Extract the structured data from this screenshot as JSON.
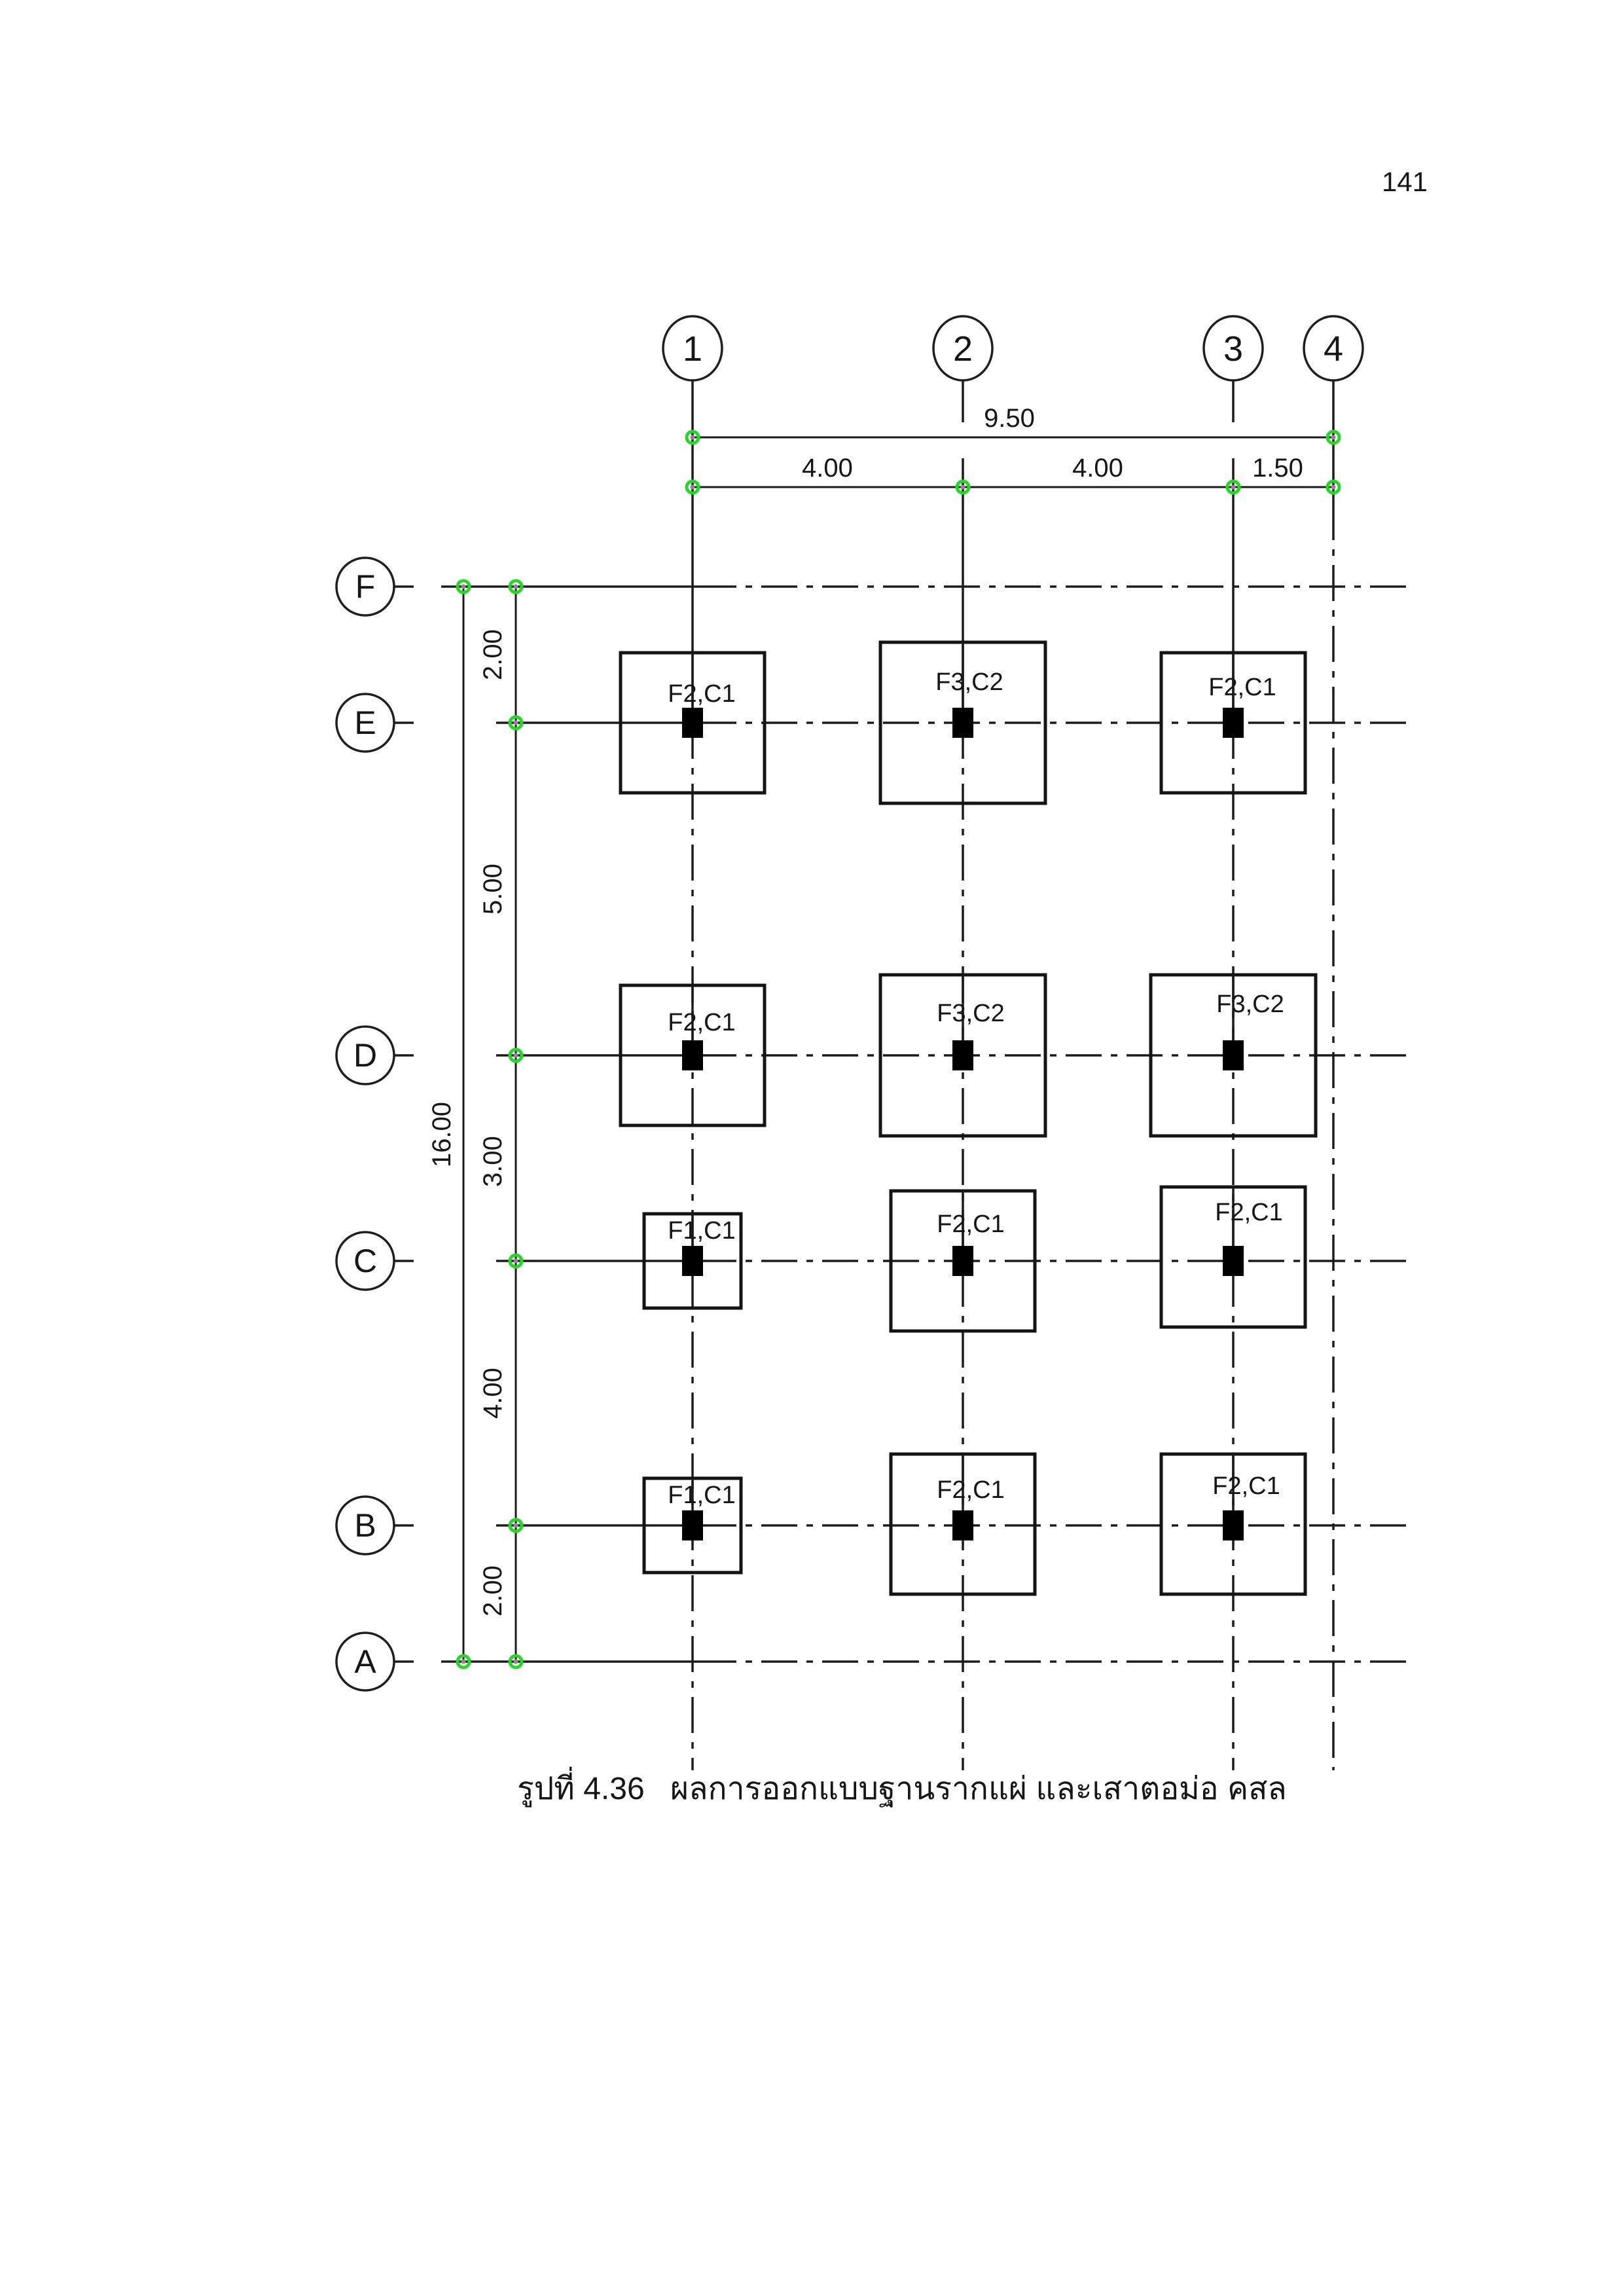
{
  "page": {
    "number": "141"
  },
  "caption": {
    "prefix": "รูปที่ 4.36",
    "text": "ผลการออกแบบฐานรากแผ่ และเสาตอม่อ คสล"
  },
  "colors": {
    "line": "#1b1b1b",
    "marker_green": "#2bd42b",
    "column_black": "#000000",
    "paper": "#ffffff"
  },
  "plan": {
    "column_grids": [
      {
        "label": "1"
      },
      {
        "label": "2"
      },
      {
        "label": "3"
      },
      {
        "label": "4"
      }
    ],
    "row_grids": [
      {
        "label": "F"
      },
      {
        "label": "E"
      },
      {
        "label": "D"
      },
      {
        "label": "C"
      },
      {
        "label": "B"
      },
      {
        "label": "A"
      }
    ],
    "dimensions": {
      "top_total": "9.50",
      "top_segments": [
        "4.00",
        "4.00",
        "1.50"
      ],
      "left_total": "16.00",
      "left_segments": [
        "2.00",
        "5.00",
        "3.00",
        "4.00",
        "2.00"
      ]
    },
    "footings": [
      {
        "grid": "E1",
        "label": "F2,C1"
      },
      {
        "grid": "E2",
        "label": "F3,C2"
      },
      {
        "grid": "E3",
        "label": "F2,C1"
      },
      {
        "grid": "D1",
        "label": "F2,C1"
      },
      {
        "grid": "D2",
        "label": "F3,C2"
      },
      {
        "grid": "D3",
        "label": "F3,C2"
      },
      {
        "grid": "C1",
        "label": "F1,C1"
      },
      {
        "grid": "C2",
        "label": "F2,C1"
      },
      {
        "grid": "C3",
        "label": "F2,C1"
      },
      {
        "grid": "B1",
        "label": "F1,C1"
      },
      {
        "grid": "B2",
        "label": "F2,C1"
      },
      {
        "grid": "B3",
        "label": "F2,C1"
      }
    ]
  }
}
